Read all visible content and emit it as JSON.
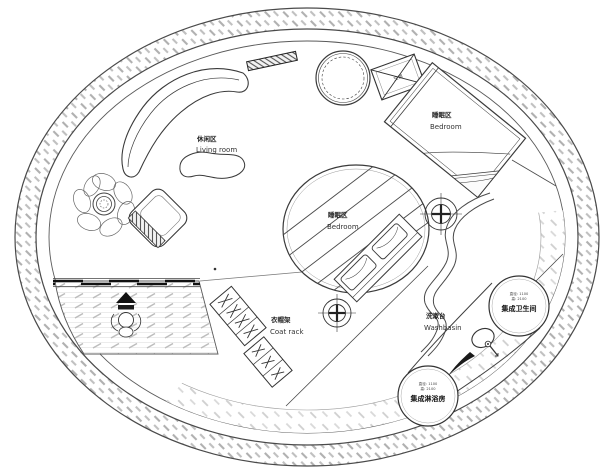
{
  "floor_plan": {
    "labels": {
      "living_zh": "休闲区",
      "living_en": "Living room",
      "bedroom1_zh": "睡眠区",
      "bedroom1_en": "Bedroom",
      "bedroom2_zh": "睡眠区",
      "bedroom2_en": "Bedroom",
      "coatrack_zh": "衣帽架",
      "coatrack_en": "Coat rack",
      "washbasin_zh": "洗漱台",
      "washbasin_en": "Washbasin",
      "bathroom_pod_dim1": "直径: 1100",
      "bathroom_pod_dim2": "高: 2100",
      "bathroom_pod_name": "集成卫生间",
      "shower_pod_dim1": "直径: 1100",
      "shower_pod_dim2": "高: 2100",
      "shower_pod_name": "集成淋浴房",
      "ac_unit": "空调"
    },
    "colors": {
      "line": "#3a3a3a",
      "wall_hatch": "#b7b7b7",
      "deck_hatch": "#c6c6c6",
      "window_wall": "#111111",
      "background": "#ffffff"
    }
  }
}
